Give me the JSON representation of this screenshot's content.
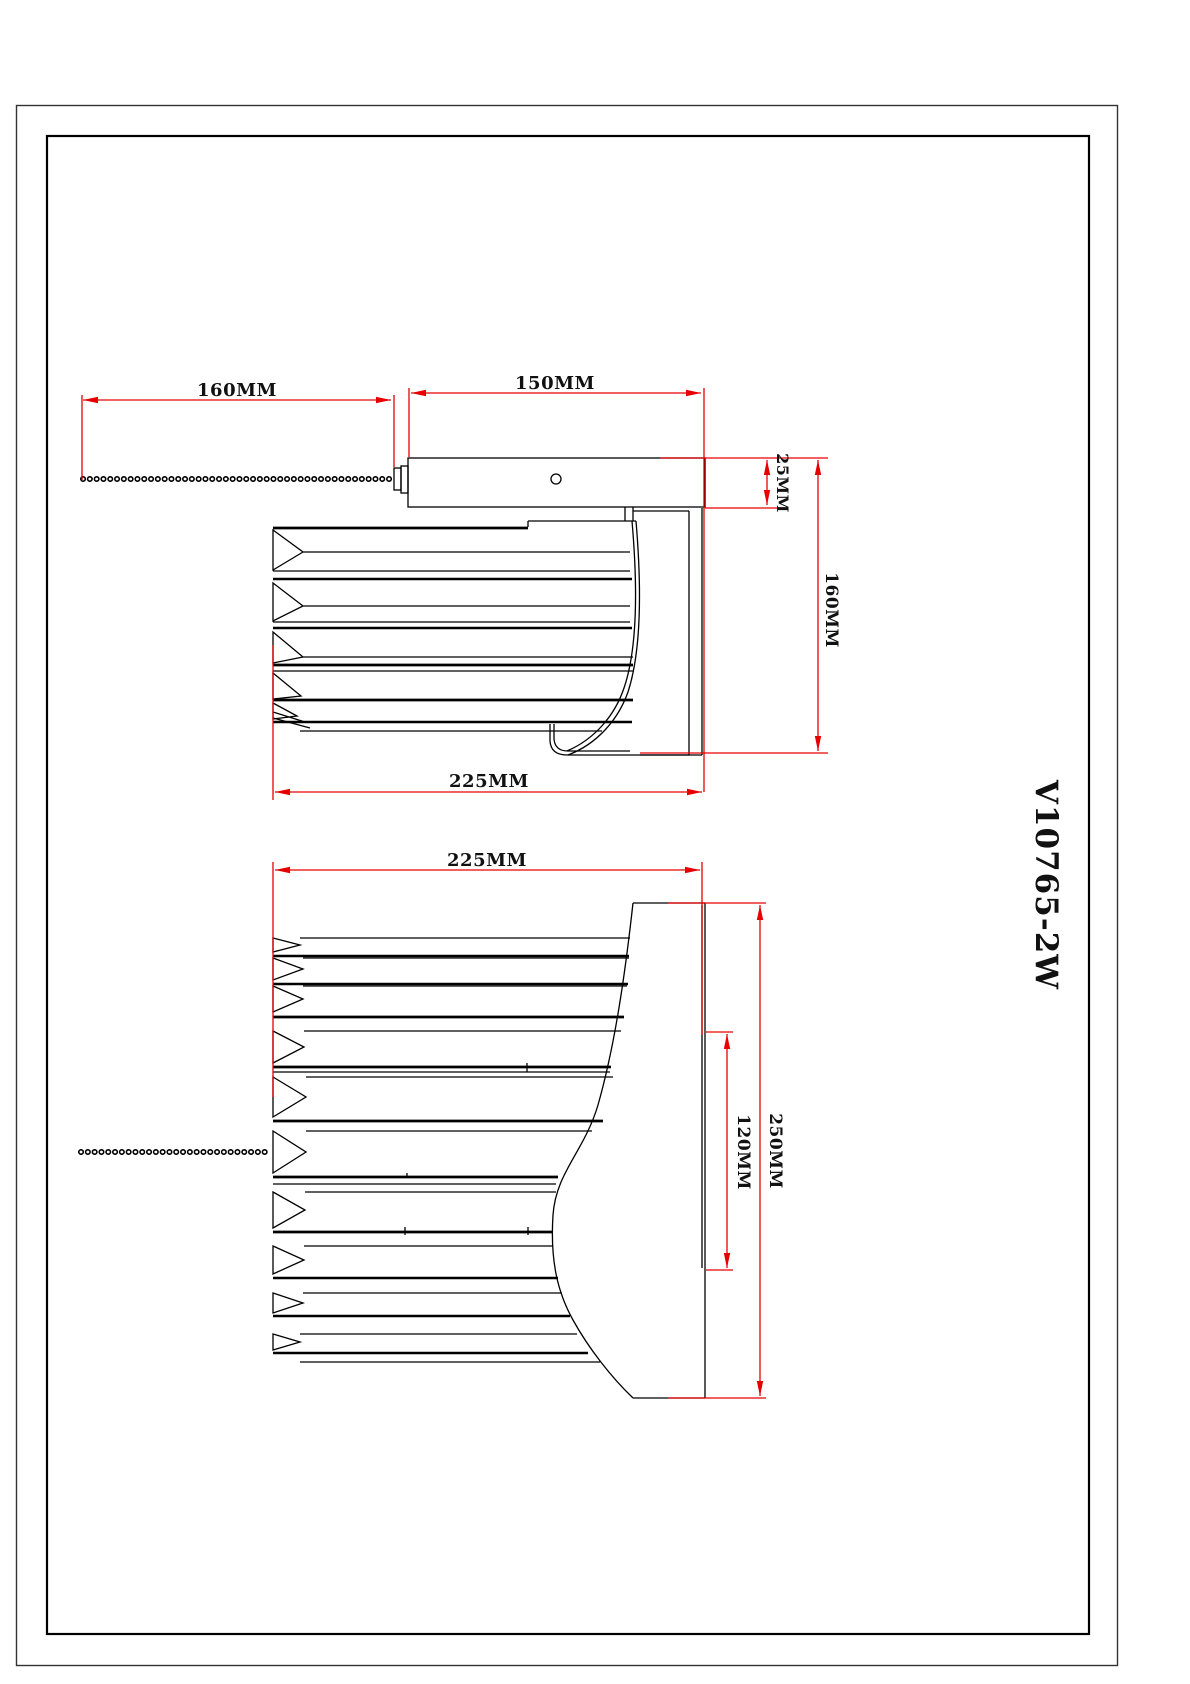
{
  "part_number": "V10765-2W",
  "colors": {
    "line": "#000000",
    "dimension": "#e60000",
    "background": "#ffffff"
  },
  "side_view": {
    "chain_length": "160MM",
    "arm_length": "150MM",
    "arm_thickness": "25MM",
    "body_height": "160MM",
    "body_length": "225MM"
  },
  "front_view": {
    "body_length": "225MM",
    "glass_height": "120MM",
    "overall_height": "250MM"
  }
}
